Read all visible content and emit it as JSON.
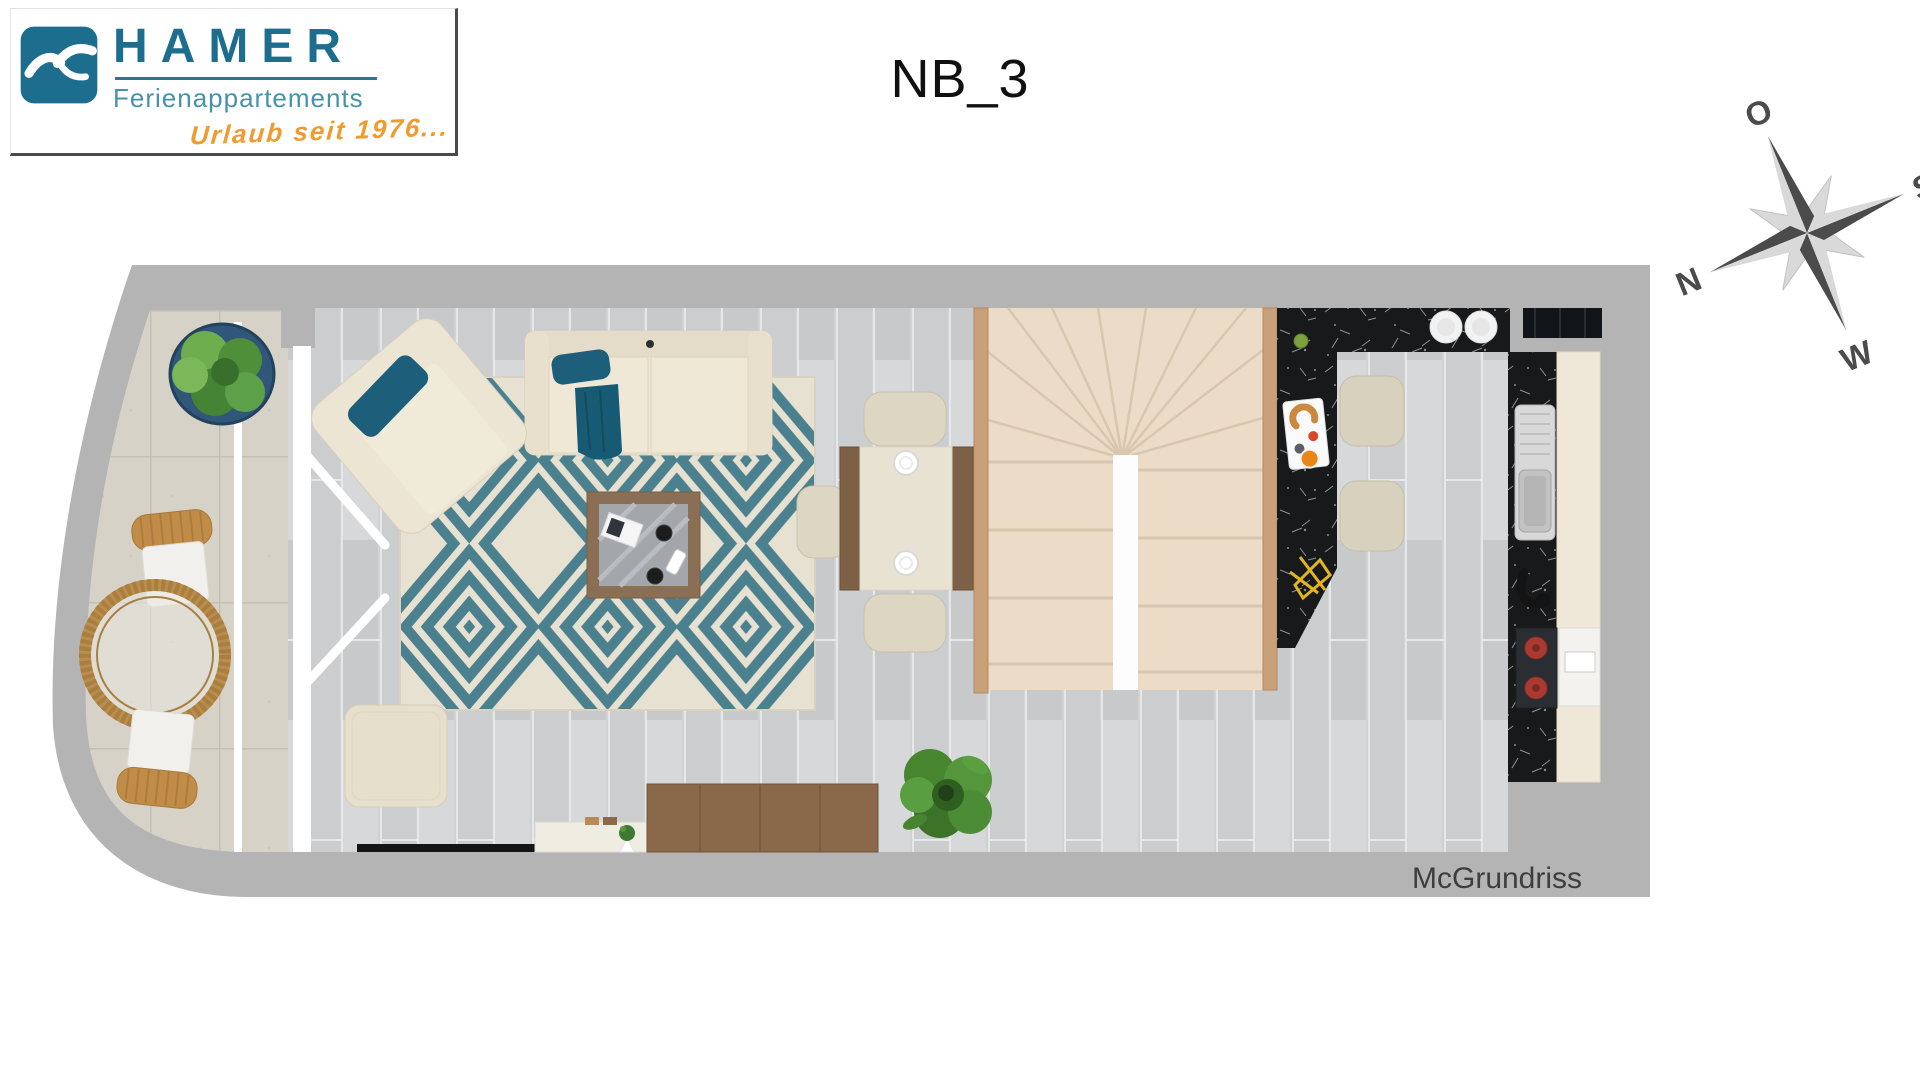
{
  "logo": {
    "brand": "HAMER",
    "subtitle": "Ferienappartements",
    "tagline": "Urlaub seit 1976...",
    "colors": {
      "brand": "#1d6d8e",
      "subtitle": "#4792ab",
      "tagline": "#f09a30",
      "mark_bg": "#1d6d8e"
    }
  },
  "page_title": "NB_3",
  "compass": {
    "labels": {
      "east": "O",
      "south": "S",
      "west": "W",
      "north": "N"
    },
    "rotation_deg": -22,
    "colors": {
      "dark": "#4b4b4b",
      "light": "#d9d9d9"
    }
  },
  "floorplan": {
    "watermark": "McGrundriss",
    "colors": {
      "wall": "#b4b4b4",
      "wood_floor": "#d1d2d4",
      "balcony_tile": "#d6d2c7",
      "rug_teal": "#4b818e",
      "rug_cream": "#e7e1d2",
      "sofa_cream": "#ece5d3",
      "pillow_teal": "#1d5f7a",
      "stair_carpet": "#ecdbc6",
      "stair_wood": "#c8a179",
      "counter_marble": "#17191b",
      "cabinet_cream": "#efe8d8",
      "dining_wood": "#7d6147",
      "sideboard_wood": "#8a684a",
      "plant_green": "#4f8f3a",
      "stool_cream": "#d8d1bd",
      "wicker_tan": "#c08c48"
    },
    "furniture": [
      "balcony-plant",
      "wicker-chair",
      "round-wicker-table",
      "armchair",
      "sofa",
      "area-rug",
      "coffee-table",
      "pouf",
      "tv-panel",
      "console-desk",
      "sideboard",
      "floor-plant",
      "dining-table",
      "dining-chairs",
      "staircase",
      "bar-counter",
      "bar-stools",
      "breakfast-tray",
      "kitchen-counter",
      "sink",
      "faucet",
      "cooktop",
      "oven",
      "wall-cabinet"
    ]
  }
}
